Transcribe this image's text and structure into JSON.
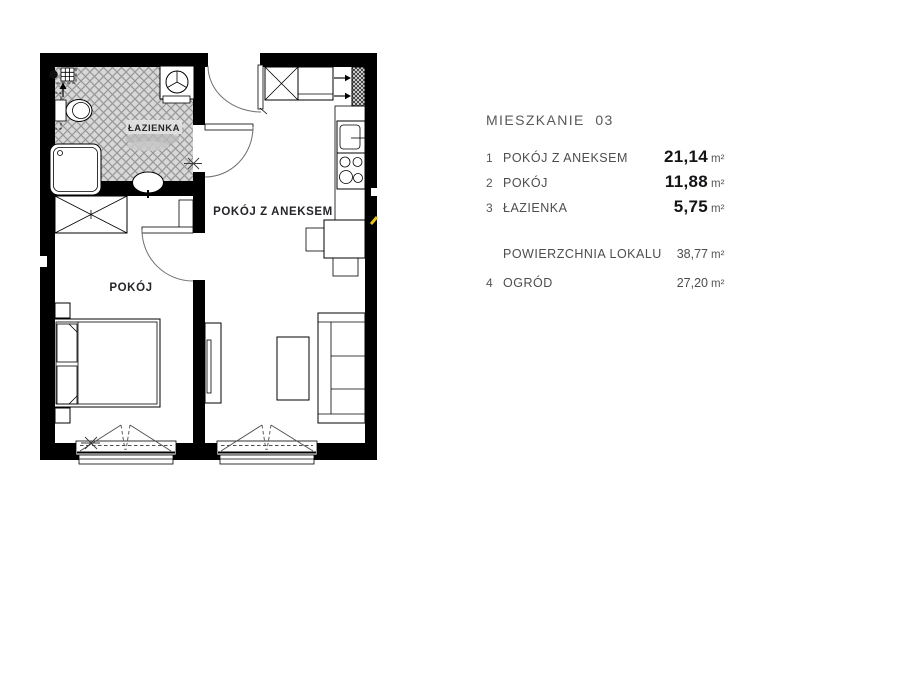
{
  "legend": {
    "title": "MIESZKANIE  03",
    "rows": [
      {
        "no": "1",
        "label": "POKÓJ Z ANEKSEM",
        "value": "21,14",
        "unit": "m²"
      },
      {
        "no": "2",
        "label": "POKÓJ",
        "value": "11,88",
        "unit": "m²"
      },
      {
        "no": "3",
        "label": "ŁAZIENKA",
        "value": "5,75",
        "unit": "m²"
      }
    ],
    "summary": {
      "label": "POWIERZCHNIA LOKALU",
      "value": "38,77",
      "unit": "m²"
    },
    "extra": {
      "no": "4",
      "label": "OGRÓD",
      "value": "27,20",
      "unit": "m²"
    }
  },
  "plan": {
    "labels": {
      "bathroom": "ŁAZIENKA",
      "room": "POKÓJ",
      "room_annex": "POKÓJ Z ANEKSEM"
    }
  },
  "colors": {
    "wall": "#000000",
    "bath_hatch_bg": "#d8d8d8",
    "bath_hatch_line": "#979797",
    "legend_text": "#55565a",
    "value_text": "#141416",
    "marker_yellow": "#e3c319"
  }
}
